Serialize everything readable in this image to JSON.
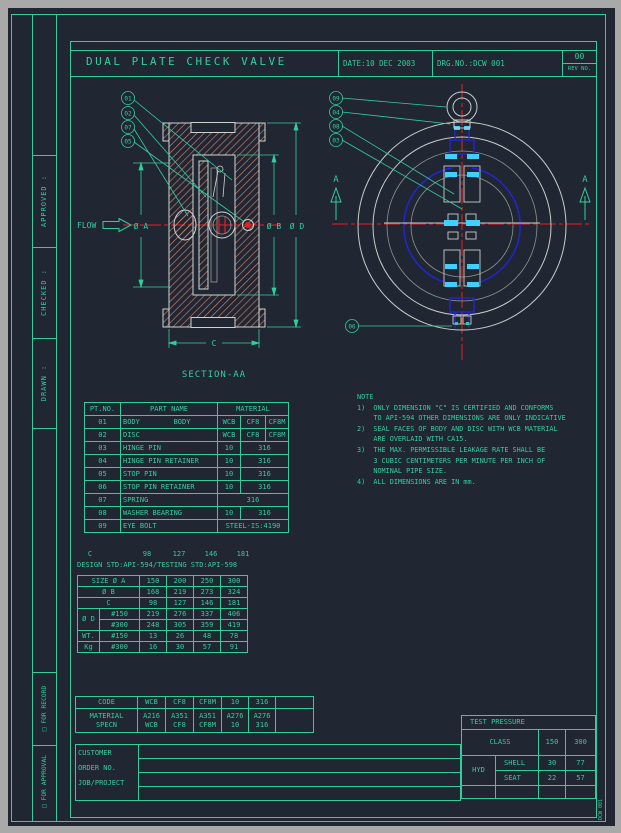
{
  "title_block": {
    "title": "DUAL PLATE CHECK VALVE",
    "date": "DATE:10 DEC 2003",
    "drg_no": "DRG.NO.:DCW 001",
    "rev_value": "00",
    "rev_label": "REV NO."
  },
  "margin": {
    "approved": "APPROVED :",
    "checked": "CHECKED :",
    "drawn": "DRAWN :",
    "for_record": "□  FOR RECORD",
    "for_approval": "□  FOR APPROVAL"
  },
  "left_view": {
    "flow": "FLOW",
    "balloons": [
      "01",
      "02",
      "07",
      "05"
    ],
    "dim_a": "Ø A",
    "dim_b": "Ø B",
    "dim_d": "Ø D",
    "dim_c": "C",
    "caption": "SECTION-AA"
  },
  "right_view": {
    "balloons": [
      "09",
      "04",
      "08",
      "03"
    ],
    "balloon_bottom": "06",
    "section_letter_left": "A",
    "section_letter_right": "A"
  },
  "notes": {
    "lines": [
      "NOTE",
      "1)  ONLY DIMENSION \"C\" IS CERTIFIED AND CONFORMS",
      "    TO API-594 OTHER DIMENSIONS ARE ONLY INDICATIVE",
      "2)  SEAL FACES OF BODY AND DISC WITH WCB MATERIAL",
      "    ARE OVERLAID WITH CA15.",
      "3)  THE MAX. PERMISSIBLE LEAKAGE RATE SHALL BE",
      "    3 CUBIC CENTIMETERS PER MINUTE PER INCH OF",
      "    NOMINAL PIPE SIZE.",
      "4)  ALL DIMENSIONS ARE IN mm."
    ]
  },
  "parts_table": {
    "cols": [
      36,
      97,
      23,
      25,
      23
    ],
    "rows": [
      {
        "h": 13,
        "cells": [
          {
            "t": "PT.NO."
          },
          {
            "t": "PART NAME"
          },
          {
            "t": "MATERIAL",
            "c": 3
          }
        ]
      },
      {
        "h": 13,
        "cells": [
          {
            "t": "01"
          },
          {
            "t": "BODY        BODY",
            "cls": "l"
          },
          {
            "t": "WCB"
          },
          {
            "t": "CF8"
          },
          {
            "t": "CF8M"
          }
        ]
      },
      {
        "h": 13,
        "cells": [
          {
            "t": "02"
          },
          {
            "t": "DISC",
            "cls": "l"
          },
          {
            "t": "WCB"
          },
          {
            "t": "CF8"
          },
          {
            "t": "CF8M"
          }
        ]
      },
      {
        "h": 13,
        "cells": [
          {
            "t": "03"
          },
          {
            "t": "HINGE PIN",
            "cls": "l"
          },
          {
            "t": "10"
          },
          {
            "t": "316",
            "c": 2
          }
        ]
      },
      {
        "h": 13,
        "cells": [
          {
            "t": "04"
          },
          {
            "t": "HINGE PIN RETAINER",
            "cls": "l"
          },
          {
            "t": "10"
          },
          {
            "t": "316",
            "c": 2
          }
        ]
      },
      {
        "h": 13,
        "cells": [
          {
            "t": "05"
          },
          {
            "t": "STOP PIN",
            "cls": "l"
          },
          {
            "t": "10"
          },
          {
            "t": "316",
            "c": 2
          }
        ]
      },
      {
        "h": 13,
        "cells": [
          {
            "t": "06"
          },
          {
            "t": "STOP PIN RETAINER",
            "cls": "l"
          },
          {
            "t": "10"
          },
          {
            "t": "316",
            "c": 2
          }
        ]
      },
      {
        "h": 13,
        "cells": [
          {
            "t": "07"
          },
          {
            "t": "SPRING",
            "cls": "l"
          },
          {
            "t": "316",
            "c": 3
          }
        ]
      },
      {
        "h": 13,
        "cells": [
          {
            "t": "08"
          },
          {
            "t": "WASHER BEARING",
            "cls": "l"
          },
          {
            "t": "10"
          },
          {
            "t": "316",
            "c": 2
          }
        ]
      },
      {
        "h": 13,
        "cells": [
          {
            "t": "09"
          },
          {
            "t": "EYE BOLT",
            "cls": "l"
          },
          {
            "t": "STEEL-IS:4190",
            "c": 3
          }
        ]
      }
    ]
  },
  "dim_block": {
    "c_row": {
      "cols": [
        16,
        33,
        32,
        32,
        32,
        32
      ],
      "rows": [
        {
          "h": 10,
          "cells": [
            {
              "t": "C"
            },
            {
              "t": ""
            },
            {
              "t": "98"
            },
            {
              "t": "127"
            },
            {
              "t": "146"
            },
            {
              "t": "181"
            }
          ]
        }
      ]
    },
    "std_line": "DESIGN STD:API-594/TESTING STD:API-598",
    "table": {
      "cols": [
        22,
        40,
        27,
        27,
        27,
        27
      ],
      "rows": [
        {
          "h": 11,
          "cells": [
            {
              "t": "SIZE Ø A",
              "c": 2
            },
            {
              "t": "150"
            },
            {
              "t": "200"
            },
            {
              "t": "250"
            },
            {
              "t": "300"
            }
          ]
        },
        {
          "h": 11,
          "cells": [
            {
              "t": "Ø B",
              "c": 2
            },
            {
              "t": "168"
            },
            {
              "t": "219"
            },
            {
              "t": "273"
            },
            {
              "t": "324"
            }
          ]
        },
        {
          "h": 11,
          "cells": [
            {
              "t": "C",
              "c": 2
            },
            {
              "t": "98"
            },
            {
              "t": "127"
            },
            {
              "t": "146"
            },
            {
              "t": "181"
            }
          ]
        },
        {
          "h": 11,
          "cells": [
            {
              "t": "Ø D",
              "r": 2
            },
            {
              "t": "#150"
            },
            {
              "t": "219"
            },
            {
              "t": "276"
            },
            {
              "t": "337"
            },
            {
              "t": "406"
            }
          ]
        },
        {
          "h": 11,
          "cells": [
            {
              "t": "#300"
            },
            {
              "t": "248"
            },
            {
              "t": "305"
            },
            {
              "t": "359"
            },
            {
              "t": "419"
            }
          ]
        },
        {
          "h": 11,
          "cells": [
            {
              "t": "WT."
            },
            {
              "t": "#150"
            },
            {
              "t": "13"
            },
            {
              "t": "26"
            },
            {
              "t": "48"
            },
            {
              "t": "78"
            }
          ]
        },
        {
          "h": 11,
          "cells": [
            {
              "t": "Kg"
            },
            {
              "t": "#300"
            },
            {
              "t": "16"
            },
            {
              "t": "30"
            },
            {
              "t": "57"
            },
            {
              "t": "91"
            }
          ]
        }
      ]
    }
  },
  "code_table": {
    "cols": [
      62,
      28,
      28,
      28,
      27,
      27,
      38
    ],
    "rows": [
      {
        "h": 12,
        "cells": [
          {
            "t": "CODE"
          },
          {
            "t": "WCB"
          },
          {
            "t": "CF8"
          },
          {
            "t": "CF8M"
          },
          {
            "t": "10"
          },
          {
            "t": "316"
          },
          {
            "t": ""
          }
        ]
      },
      {
        "h": 24,
        "cells": [
          {
            "t": "MATERIAL\nSPECN"
          },
          {
            "t": "A216\nWCB"
          },
          {
            "t": "A351\nCF8"
          },
          {
            "t": "A351\nCF8M"
          },
          {
            "t": "A276\n10"
          },
          {
            "t": "A276\n316"
          },
          {
            "t": ""
          }
        ]
      }
    ]
  },
  "customer_block": {
    "cols": [
      63,
      322
    ],
    "rows": [
      {
        "h": 14,
        "cells": [
          {
            "t": "CUSTOMER\nORDER NO.\nJOB/PROJECT",
            "r": 4,
            "cls": "l top"
          },
          {
            "t": ""
          }
        ]
      },
      {
        "h": 14,
        "cells": [
          {
            "t": ""
          }
        ]
      },
      {
        "h": 14,
        "cells": [
          {
            "t": ""
          }
        ]
      },
      {
        "h": 14,
        "cells": [
          {
            "t": ""
          }
        ]
      }
    ]
  },
  "test_table": {
    "cols": [
      34,
      43,
      27,
      30
    ],
    "rows": [
      {
        "h": 14,
        "cells": [
          {
            "t": "TEST PRESSURE",
            "c": 4,
            "cls": "l pad"
          }
        ]
      },
      {
        "h": 26,
        "cells": [
          {
            "t": "CLASS",
            "c": 2
          },
          {
            "t": "150"
          },
          {
            "t": "300"
          }
        ]
      },
      {
        "h": 15,
        "cells": [
          {
            "t": "HYD",
            "r": 2
          },
          {
            "t": "SHELL",
            "cls": "l pad"
          },
          {
            "t": "30"
          },
          {
            "t": "77"
          }
        ]
      },
      {
        "h": 15,
        "cells": [
          {
            "t": "SEAT",
            "cls": "l pad"
          },
          {
            "t": "22"
          },
          {
            "t": "57"
          }
        ]
      },
      {
        "h": 13,
        "cells": [
          {
            "t": ""
          },
          {
            "t": ""
          },
          {
            "t": ""
          },
          {
            "t": ""
          }
        ]
      }
    ]
  },
  "sheet_label_vertical": "DCW 001",
  "colors": {
    "background": "#202733",
    "frame_grey": "#a9a9a9",
    "line_teal": "#33cd9d",
    "outline_white": "#cfd3cf",
    "outline_grey": "#8f938f",
    "plate_blue": "#2424d8",
    "pad_cyan": "#3fd0ff",
    "centerline_red": "#e82020",
    "hatch_salmon": "#d98872"
  }
}
